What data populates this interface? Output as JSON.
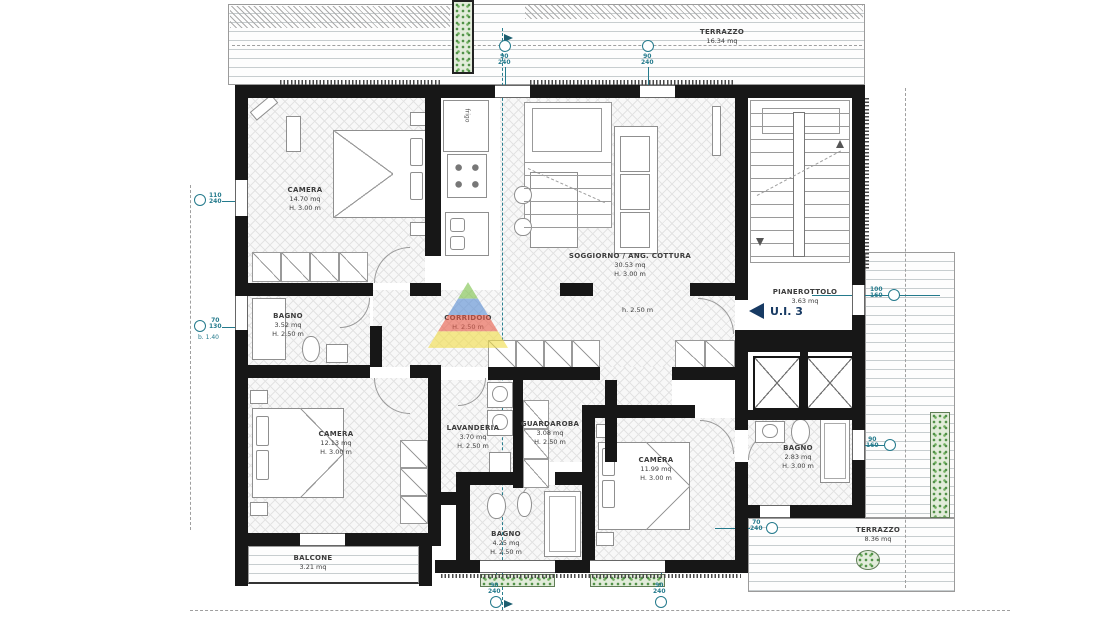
{
  "plan": {
    "unit": {
      "label": "U.I. 3"
    },
    "rooms": [
      {
        "name": "CAMERA",
        "area": "14.70 mq",
        "height": "H. 3.00 m"
      },
      {
        "name": "SOGGIORNO / ANG. COTTURA",
        "area": "30.53 mq",
        "height": "H. 3.00 m"
      },
      {
        "name": "PIANEROTTOLO",
        "area": "3.63 mq",
        "height": ""
      },
      {
        "name": "BAGNO",
        "area": "3.52 mq",
        "height": "H. 2.50 m"
      },
      {
        "name": "CORRIDOIO",
        "area": "",
        "height": "H. 2.50 m"
      },
      {
        "name": "CAMERA",
        "area": "12.13 mq",
        "height": "H. 3.00 m"
      },
      {
        "name": "LAVANDERIA",
        "area": "3.70 mq",
        "height": "H. 2.50 m"
      },
      {
        "name": "GUARDAROBA",
        "area": "3.08 mq",
        "height": "H. 2.50 m"
      },
      {
        "name": "BAGNO",
        "area": "4.25 mq",
        "height": "H. 2.50 m"
      },
      {
        "name": "CAMERA",
        "area": "11.99 mq",
        "height": "H. 3.00 m"
      },
      {
        "name": "BAGNO",
        "area": "2.83 mq",
        "height": "H. 3.00 m"
      }
    ],
    "outdoor": [
      {
        "name": "TERRAZZO",
        "area": "16.34 mq"
      },
      {
        "name": "BALCONE",
        "area": "3.21 mq"
      },
      {
        "name": "TERRAZZO",
        "area": "8.36 mq"
      }
    ],
    "notes": {
      "corridor_height": "h. 2.50 m",
      "fridge": "frigo",
      "sill": "b. 1.40"
    },
    "window_markers": [
      {
        "top": "110",
        "bottom": "240"
      },
      {
        "top": "70",
        "bottom": "130"
      },
      {
        "top": "90",
        "bottom": "240"
      },
      {
        "top": "90",
        "bottom": "240"
      },
      {
        "top": "100",
        "bottom": "160"
      },
      {
        "top": "90",
        "bottom": "160"
      },
      {
        "top": "70",
        "bottom": "240"
      },
      {
        "top": "90",
        "bottom": "240"
      },
      {
        "top": "90",
        "bottom": "240"
      }
    ],
    "colors": {
      "wall": "#171717",
      "marker": "#247a8c",
      "unit_accent": "#173a63",
      "plant": "#4e8f45",
      "watermark": [
        "#7dc24b",
        "#5b8fd4",
        "#e85c4a",
        "#f2de4a"
      ]
    }
  }
}
